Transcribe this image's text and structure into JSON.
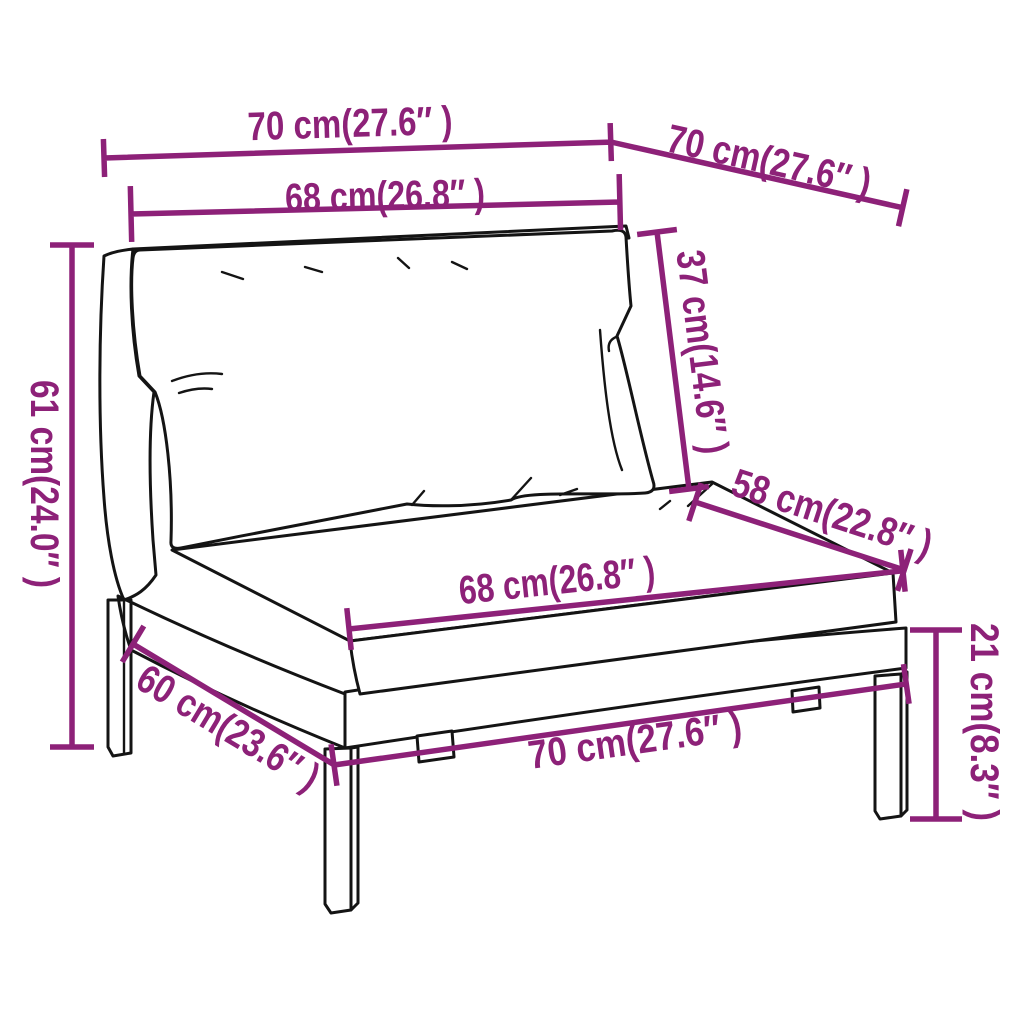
{
  "canvas": {
    "background": "#ffffff",
    "width": 1024,
    "height": 1024
  },
  "style": {
    "dimension_color": "#8d2178",
    "line_art_color": "#141414"
  },
  "diagram": {
    "kind": "product dimension diagram",
    "subject": "poly rattan garden sofa middle section with cushions",
    "dimensions": [
      {
        "id": "seat-top-width",
        "label": "70 cm(27.6″ )"
      },
      {
        "id": "seat-top-depth",
        "label": "70 cm(27.6″ )"
      },
      {
        "id": "backrest-width",
        "label": "68 cm(26.8″ )"
      },
      {
        "id": "overall-height",
        "label": "61 cm(24.0″ )"
      },
      {
        "id": "back-cushion-height",
        "label": "37 cm(14.6″ )"
      },
      {
        "id": "seat-cushion-depth",
        "label": "58 cm(22.8″ )"
      },
      {
        "id": "seat-cushion-width",
        "label": "68 cm(26.8″ )"
      },
      {
        "id": "base-side-depth",
        "label": "60 cm(23.6″ )"
      },
      {
        "id": "base-front-width",
        "label": "70 cm(27.6″ )"
      },
      {
        "id": "leg-height",
        "label": "21 cm(8.3″ )"
      }
    ]
  }
}
